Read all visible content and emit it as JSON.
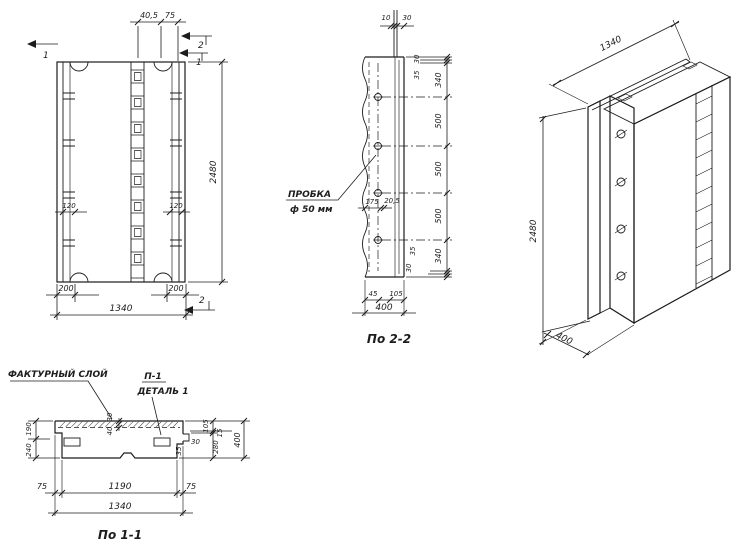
{
  "meta": {
    "ink_color": "#1c1c1c",
    "paper_color": "#ffffff",
    "drawing_type": "concrete wall panel working drawing"
  },
  "front": {
    "dim_top_a": "40,5",
    "dim_top_b": "75",
    "dim_height": "2480",
    "dim_anchor_left": "120",
    "dim_anchor_right": "120",
    "dim_bottom_left": "200",
    "dim_bottom_right": "200",
    "dim_width": "1340",
    "marker_top_left": "1",
    "marker_top_right_upper": "2",
    "marker_top_right_lower": "1",
    "marker_bottom_right": "2"
  },
  "section22": {
    "caption": "По 2-2",
    "plug_line1": "ПРОБКА",
    "plug_line2": "ф 50 мм",
    "dim_rod_left": "10",
    "dim_rod_right": "30",
    "dim_edge_top_30": "30",
    "dim_edge_top_35": "35",
    "dims_right": [
      "340",
      "500",
      "500",
      "500",
      "340"
    ],
    "dim_edge_bottom_35": "35",
    "dim_edge_bottom_30": "30",
    "dim_inner_175": "175",
    "dim_inner_205": "20,5",
    "dim_foot_45": "45",
    "dim_foot_105": "105",
    "dim_depth": "400"
  },
  "iso": {
    "dim_width": "1340",
    "dim_height": "2480",
    "dim_depth": "400"
  },
  "section11": {
    "caption": "По 1-1",
    "label_texture": "ФАКТУРНЫЙ СЛОЙ",
    "label_detail_ref": "П-1",
    "label_detail_name": "ДЕТАЛЬ 1",
    "dim_190": "190",
    "dim_240": "240",
    "dim_30": "30",
    "dim_40": "40",
    "dim_105": "105",
    "dim_15": "15",
    "dim_280": "280",
    "dim_400": "400",
    "dim_key_30": "30",
    "dim_key_35": "35",
    "dim_75_left": "75",
    "dim_1190": "1190",
    "dim_75_right": "75",
    "dim_1340": "1340"
  }
}
